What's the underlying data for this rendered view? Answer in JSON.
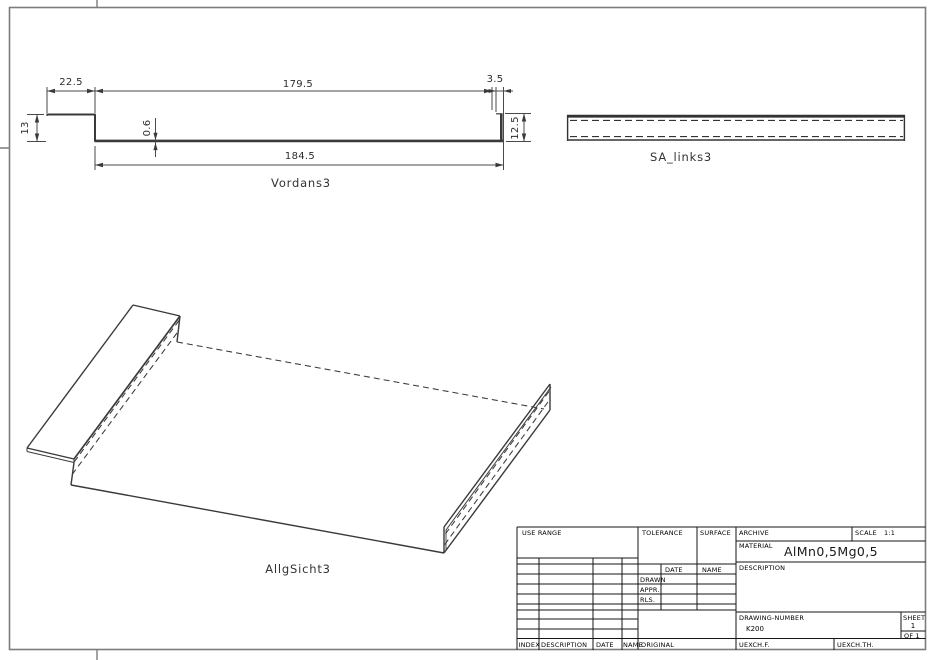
{
  "front_view": {
    "label": "Vordans3",
    "dimensions": {
      "flange_width": "22.5",
      "web_inner_length": "179.5",
      "lip_bend_width": "3.5",
      "flange_height": "13",
      "sheet_thickness": "0.6",
      "overall_length": "184.5",
      "lip_height": "12.5"
    }
  },
  "side_view": {
    "label": "SA_links3"
  },
  "iso_view": {
    "label": "AllgSicht3"
  },
  "title_block": {
    "use_range_label": "USE RANGE",
    "tolerance_label": "TOLERANCE",
    "surface_label": "SURFACE",
    "archive_label": "ARCHIVE",
    "scale_label": "SCALE",
    "scale_value": "1:1",
    "material_label": "MATERIAL",
    "material_value": "AlMn0,5Mg0,5",
    "description_label": "DESCRIPTION",
    "date_header": "DATE",
    "name_header": "NAME",
    "drawn_label": "DRAWN",
    "appr_label": "APPR.",
    "rls_label": "RLS.",
    "drawing_number_label": "DRAWING-NUMBER",
    "drawing_number_value": "K200",
    "sheet_label": "SHEET",
    "sheet_value": "1",
    "of_label": "OF 1",
    "index_label": "INDEX",
    "description2_label": "DESCRIPTION",
    "date2_label": "DATE",
    "name2_label": "NAME",
    "original_label": "ORIGINAL",
    "uexchf_label": "UEXCH.F.",
    "uexchth_label": "UEXCH.TH."
  },
  "colors": {
    "drawing_line": "#3a3a3a",
    "dimension_line": "#4a4a4a",
    "border_line": "#7c7c7c",
    "title_block_line": "#151515",
    "background": "#ffffff"
  }
}
